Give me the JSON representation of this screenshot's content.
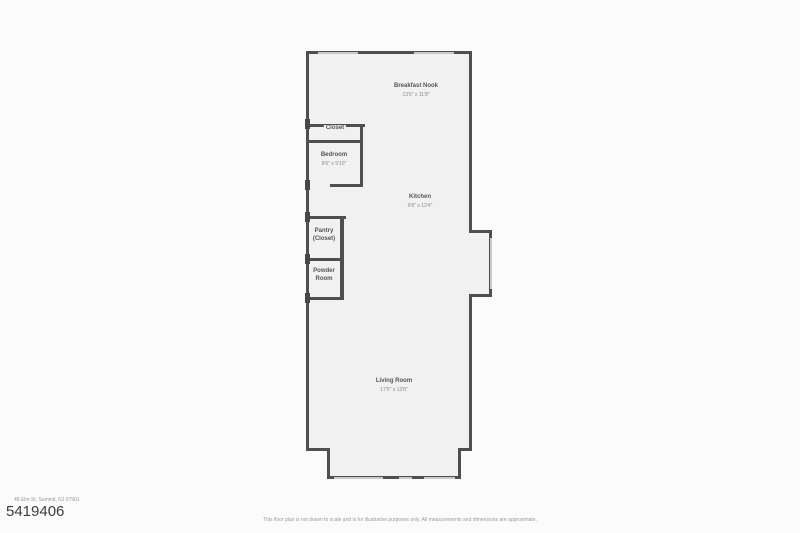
{
  "page": {
    "mls_number": "5419406",
    "address": "48 Elm St, Summit, NJ 07901",
    "disclaimer": "This floor plan is not drawn to scale and is for illustrative purposes only. All measurements and dimensions are approximate."
  },
  "rooms": {
    "breakfast_nook": {
      "name": "Breakfast Nook",
      "dims": "13'6\" x 11'8\""
    },
    "closet": {
      "name": "Closet"
    },
    "bedroom": {
      "name": "Bedroom",
      "dims": "8'6\" x 9'10\""
    },
    "kitchen": {
      "name": "Kitchen",
      "dims": "9'8\" x 13'4\""
    },
    "pantry": {
      "line1": "Pantry",
      "line2": "(Closet)"
    },
    "powder": {
      "line1": "Powder",
      "line2": "Room"
    },
    "living_room": {
      "name": "Living Room",
      "dims": "17'6\" x 13'8\""
    }
  },
  "colors": {
    "wall": "#4f4f4f",
    "window": "#c9c9c9",
    "floor": "#f1f1f1",
    "background": "#fbfbfb"
  }
}
